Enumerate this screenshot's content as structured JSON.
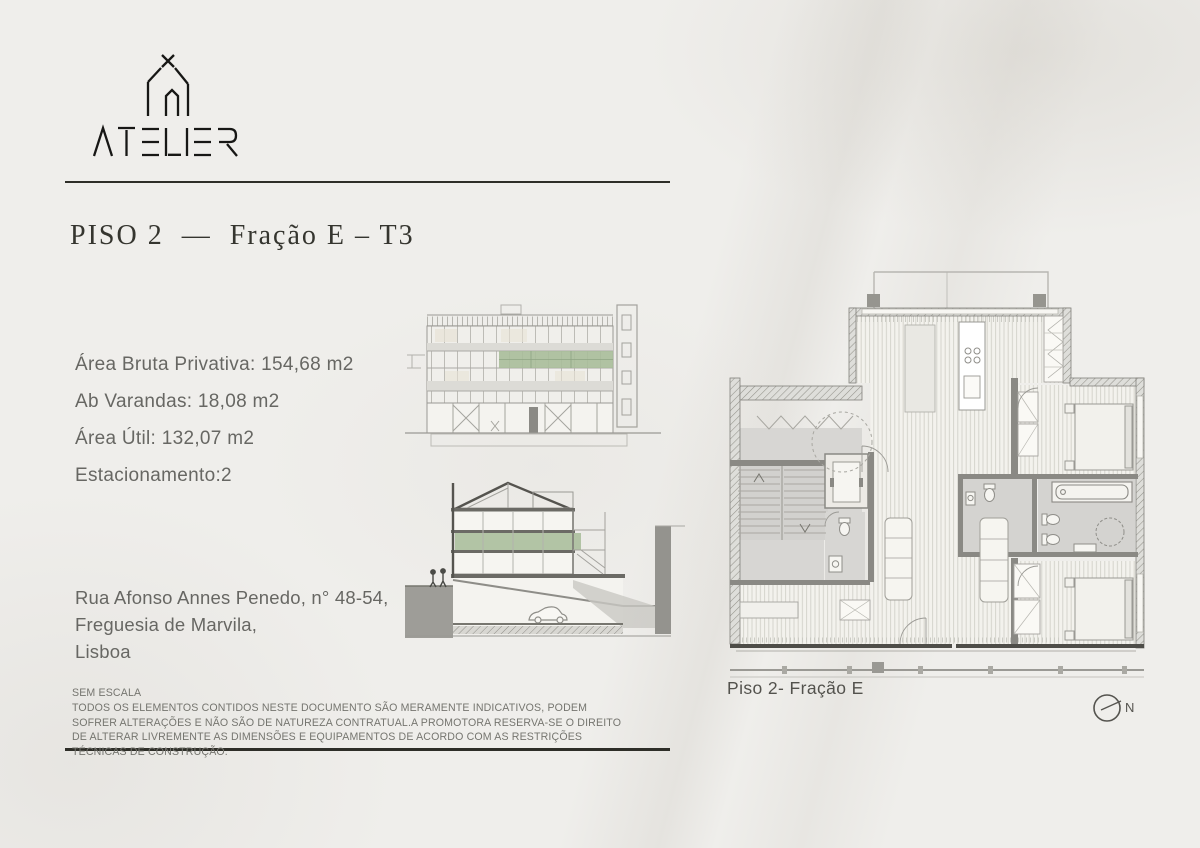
{
  "brand": {
    "name": "ATELIER"
  },
  "heading": {
    "title": "PISO 2  —  Fração E – T3"
  },
  "details": {
    "area_bruta": "Área Bruta Privativa: 154,68 m2",
    "ab_varandas": "Ab Varandas: 18,08 m2",
    "area_util": "Área Útil: 132,07 m2",
    "estacionamento": "Estacionamento:2"
  },
  "address": {
    "line1": "Rua Afonso Annes Penedo, n° 48-54,",
    "line2": "Freguesia de Marvila,",
    "line3": "Lisboa"
  },
  "disclaimer": {
    "heading": "SEM ESCALA",
    "body": "TODOS OS ELEMENTOS CONTIDOS NESTE DOCUMENTO SÃO MERAMENTE INDICATIVOS, PODEM SOFRER ALTERAÇÕES E NÃO SÃO DE NATUREZA CONTRATUAL.A PROMOTORA RESERVA-SE O DIREITO DE ALTERAR LIVREMENTE AS DIMENSÕES E EQUIPAMENTOS DE ACORDO COM AS RESTRIÇÕES TÉCNICAS DE CONSTRUÇÃO."
  },
  "plan": {
    "caption": "Piso 2- Fração E",
    "north_label": "N"
  },
  "drawings": {
    "elevation": "building-front-elevation",
    "section": "building-cross-section",
    "floor_plan": "apartment-floor-plan-piso2-fracao-e"
  },
  "colors": {
    "accent_green": "#a9bd9a",
    "rule_dark": "#2e2e28",
    "text_primary": "#35352f",
    "text_secondary": "#676763",
    "text_muted": "#75756f",
    "wall_gray": "#8a8984",
    "floor_gray": "#d7d6d3"
  }
}
